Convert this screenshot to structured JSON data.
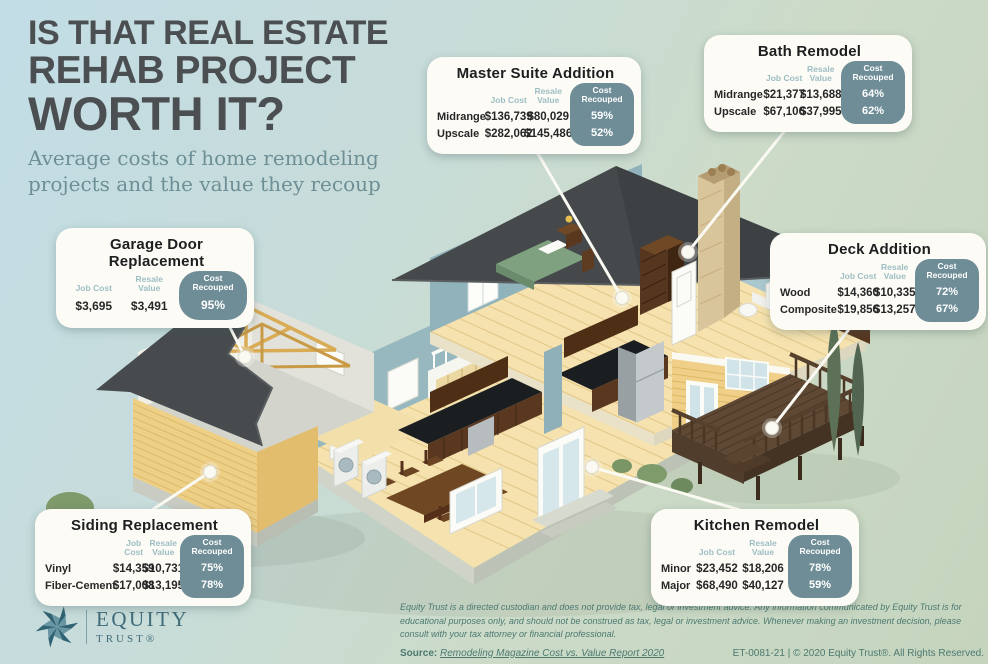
{
  "header": {
    "title_line1": "IS THAT REAL ESTATE",
    "title_line2": "REHAB PROJECT",
    "title_line3": "WORTH IT?",
    "subtitle": "Average costs of home remodeling projects and the value they recoup"
  },
  "column_headers": {
    "job_cost": "Job Cost",
    "resale_value": "Resale\nValue",
    "cost_recouped": "Cost\nRecouped"
  },
  "callouts": {
    "master_suite": {
      "title": "Master Suite Addition",
      "rows": [
        {
          "label": "Midrange",
          "job_cost": "$136,739",
          "resale_value": "$80,029",
          "cost_recouped": "59%"
        },
        {
          "label": "Upscale",
          "job_cost": "$282,062",
          "resale_value": "$145,486",
          "cost_recouped": "52%"
        }
      ]
    },
    "bath_remodel": {
      "title": "Bath Remodel",
      "rows": [
        {
          "label": "Midrange",
          "job_cost": "$21,377",
          "resale_value": "$13,688",
          "cost_recouped": "64%"
        },
        {
          "label": "Upscale",
          "job_cost": "$67,106",
          "resale_value": "$37,995",
          "cost_recouped": "62%"
        }
      ]
    },
    "garage_door": {
      "title": "Garage Door Replacement",
      "rows": [
        {
          "label": "",
          "job_cost": "$3,695",
          "resale_value": "$3,491",
          "cost_recouped": "95%"
        }
      ]
    },
    "deck_addition": {
      "title": "Deck Addition",
      "rows": [
        {
          "label": "Wood",
          "job_cost": "$14,360",
          "resale_value": "$10,335",
          "cost_recouped": "72%"
        },
        {
          "label": "Composite",
          "job_cost": "$19,856",
          "resale_value": "$13,257",
          "cost_recouped": "67%"
        }
      ]
    },
    "siding_replacement": {
      "title": "Siding Replacement",
      "rows": [
        {
          "label": "Vinyl",
          "job_cost": "$14,359",
          "resale_value": "$10,731",
          "cost_recouped": "75%"
        },
        {
          "label": "Fiber-Cement",
          "job_cost": "$17,008",
          "resale_value": "$13,195",
          "cost_recouped": "78%"
        }
      ]
    },
    "kitchen_remodel": {
      "title": "Kitchen Remodel",
      "rows": [
        {
          "label": "Minor",
          "job_cost": "$23,452",
          "resale_value": "$18,206",
          "cost_recouped": "78%"
        },
        {
          "label": "Major",
          "job_cost": "$68,490",
          "resale_value": "$40,127",
          "cost_recouped": "59%"
        }
      ]
    }
  },
  "footer": {
    "disclaimer": "Equity Trust is a directed custodian and does not provide tax, legal or investment advice. Any information communicated by Equity Trust is for educational purposes only, and should not be construed as tax, legal or investment advice. Whenever making an investment decision, please consult with your tax attorney or financial professional.",
    "source_label": "Source:",
    "source_link_text": "Remodeling Magazine Cost vs. Value Report 2020",
    "code_and_rights": "ET-0081-21 | © 2020 Equity Trust®. All Rights Reserved."
  },
  "logo": {
    "brand_top": "EQUITY",
    "brand_bottom": "TRUST®"
  },
  "colors": {
    "background_blue": "#c2dde6",
    "background_green": "#c5d4bd",
    "title_gray": "#4c4f51",
    "subtitle_teal": "#6d8f95",
    "box_background": "#fcfbf6",
    "column_header_teal": "#9dbec3",
    "recouped_pill_teal": "#6e8d96",
    "footer_teal": "#4c7972",
    "roof_gray": "#45494b",
    "siding_yellow": "#eecf86",
    "wall_blue": "#8fb2bb",
    "floor_wood": "#f5e2ae",
    "deck_brown": "#5f4935"
  }
}
